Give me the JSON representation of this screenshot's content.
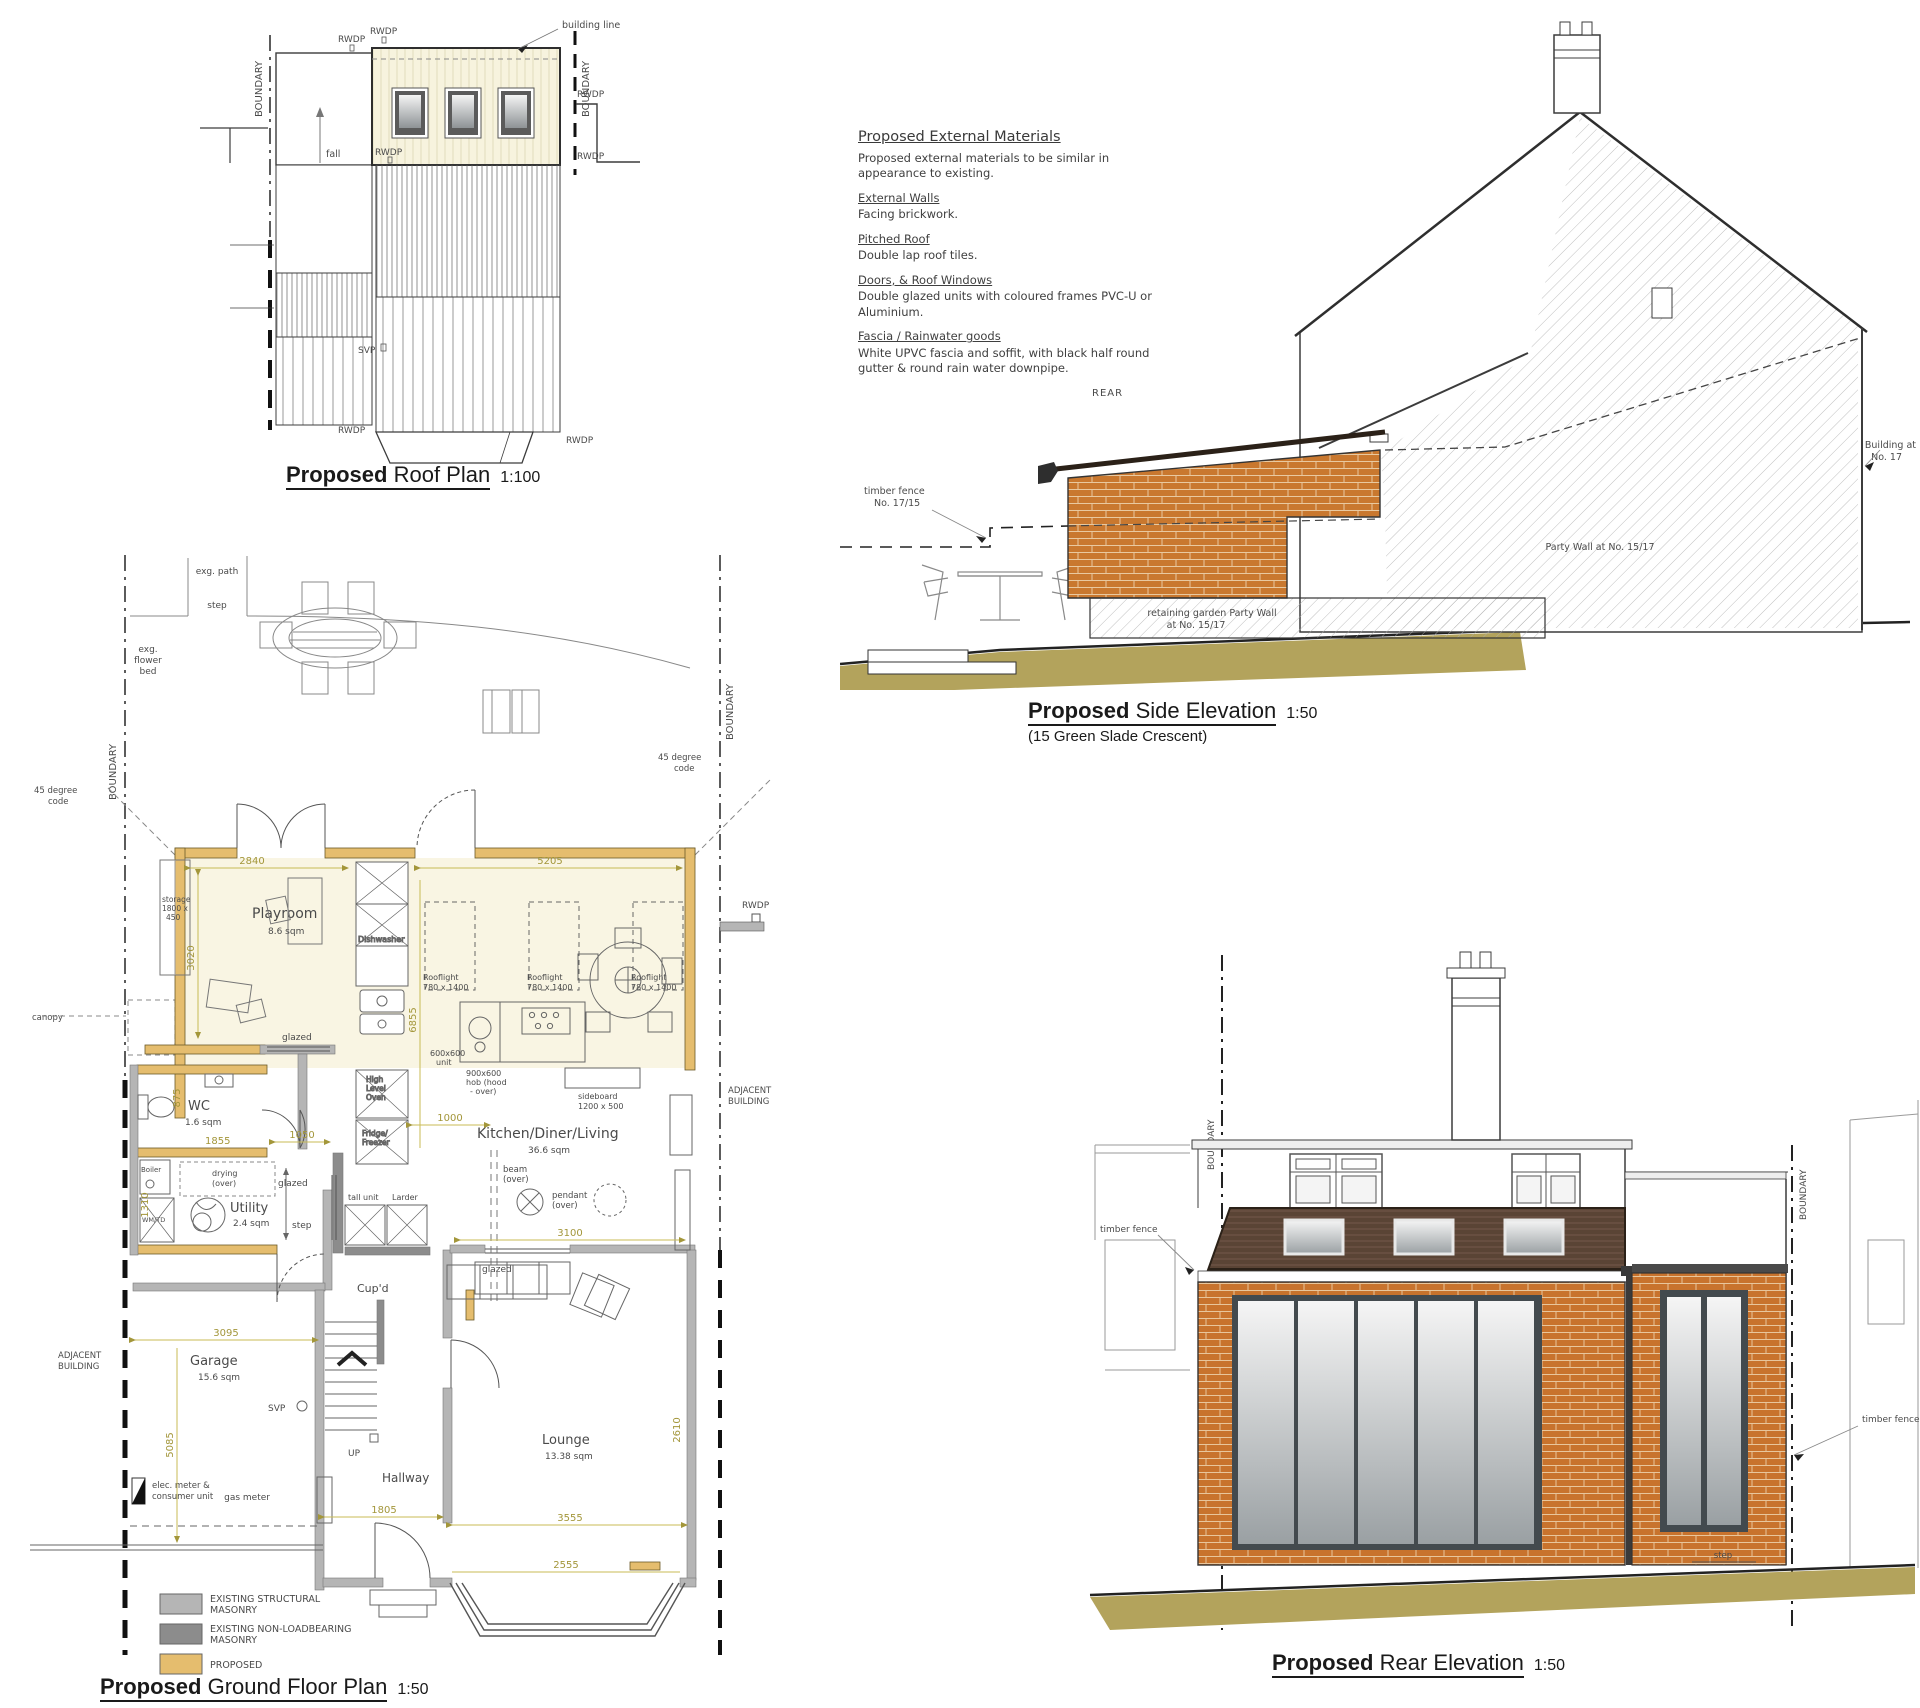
{
  "roof_plan": {
    "title_bold": "Proposed",
    "title_rest": "Roof Plan",
    "scale": "1:100",
    "labels": {
      "boundary": "BOUNDARY",
      "building_line": "building line",
      "fall": "fall",
      "rwdp": "RWDP",
      "svp": "SVP"
    }
  },
  "materials": {
    "heading": "Proposed External Materials",
    "intro": "Proposed external materials to be similar in appearance to existing.",
    "sections": [
      {
        "heading": "External Walls",
        "body": "Facing brickwork."
      },
      {
        "heading": "Pitched Roof",
        "body": "Double lap roof tiles."
      },
      {
        "heading": "Doors, & Roof Windows",
        "body": "Double glazed units with coloured frames PVC-U or Aluminium."
      },
      {
        "heading": "Fascia / Rainwater goods",
        "body": "White UPVC fascia and soffit, with black half round gutter & round rain water downpipe."
      }
    ]
  },
  "side_elevation": {
    "title_bold": "Proposed",
    "title_rest": "Side Elevation",
    "scale": "1:50",
    "subtitle": "(15 Green Slade Crescent)",
    "labels": {
      "rear": "REAR",
      "timber_fence_1": "timber fence",
      "timber_fence_2": "No. 17/15",
      "party_wall": "Party Wall at No. 15/17",
      "retaining_1": "retaining garden Party Wall",
      "retaining_2": "at No. 15/17",
      "building_1": "Building at",
      "building_2": "No. 17"
    }
  },
  "ground_floor": {
    "title_bold": "Proposed",
    "title_rest": "Ground Floor Plan",
    "scale": "1:50",
    "rooms": {
      "playroom": "Playroom",
      "playroom_area": "8.6 sqm",
      "wc": "WC",
      "wc_area": "1.6 sqm",
      "utility": "Utility",
      "utility_area": "2.4 sqm",
      "kitchen": "Kitchen/Diner/Living",
      "kitchen_area": "36.6 sqm",
      "garage": "Garage",
      "garage_area": "15.6 sqm",
      "hallway": "Hallway",
      "lounge": "Lounge",
      "lounge_area": "13.38 sqm",
      "cupd": "Cup'd"
    },
    "labels": {
      "exg_path": "exg. path",
      "step": "step",
      "flower_1": "exg.",
      "flower_2": "flower",
      "flower_3": "bed",
      "canopy": "canopy",
      "deg_1": "45 degree",
      "deg_2": "code",
      "boundary": "BOUNDARY",
      "adjacent_1": "ADJACENT",
      "adjacent_2": "BUILDING",
      "rwdp": "RWDP",
      "svp": "SVP",
      "up": "UP",
      "storage_1": "storage",
      "storage_2": "1800 x",
      "storage_3": "450",
      "dishwasher": "Dishwasher",
      "rooflight_1": "Rooflight",
      "rooflight_2": "780 x 1400",
      "hob_1": "900x600",
      "hob_2": "hob (hood",
      "hob_3": "- over)",
      "unit_1": "600x600",
      "unit_2": "unit",
      "oven_1": "High",
      "oven_2": "Level",
      "oven_3": "Oven",
      "fridge_1": "Fridge/",
      "fridge_2": "Freezer",
      "sideboard_1": "sideboard",
      "sideboard_2": "1200 x 500",
      "beam_1": "beam",
      "beam_2": "(over)",
      "pendant_1": "pendant",
      "pendant_2": "(over)",
      "glazed": "glazed",
      "boiler": "Boiler",
      "wmtd": "WM/TD",
      "drying_1": "drying",
      "drying_2": "(over)",
      "tall_unit": "tall unit",
      "larder": "Larder",
      "gas_meter": "gas meter",
      "elec_1": "elec. meter &",
      "elec_2": "consumer unit"
    },
    "dims": {
      "d2840": "2840",
      "d5205": "5205",
      "d3020": "3020",
      "d6855": "6855",
      "d1855": "1855",
      "d875": "875",
      "d1050": "1050",
      "d1000": "1000",
      "d1310": "1310",
      "d3100": "3100",
      "d3095": "3095",
      "d5085": "5085",
      "d1805": "1805",
      "d3555": "3555",
      "d2610": "2610",
      "d2555": "2555"
    },
    "legend": [
      {
        "line1": "EXISTING STRUCTURAL",
        "line2": "MASONRY",
        "color": "#b5b5b5"
      },
      {
        "line1": "EXISTING NON-LOADBEARING",
        "line2": "MASONRY",
        "color": "#8c8c8c"
      },
      {
        "line1": "PROPOSED",
        "line2": "",
        "color": "#e5bd6e"
      }
    ]
  },
  "rear_elevation": {
    "title_bold": "Proposed",
    "title_rest": "Rear Elevation",
    "scale": "1:50",
    "labels": {
      "boundary": "BOUNDARY",
      "timber_fence": "timber fence",
      "step": "step"
    }
  },
  "colors": {
    "brick": "#c9782f",
    "roof_brown": "#5a4435",
    "ground": "#b3a35c",
    "proposed_tan": "#e5bd6e",
    "masonry_light": "#b5b5b5",
    "masonry_dark": "#8c8c8c",
    "room_cream": "#f9f5e3",
    "dim_text": "#a3963a"
  }
}
